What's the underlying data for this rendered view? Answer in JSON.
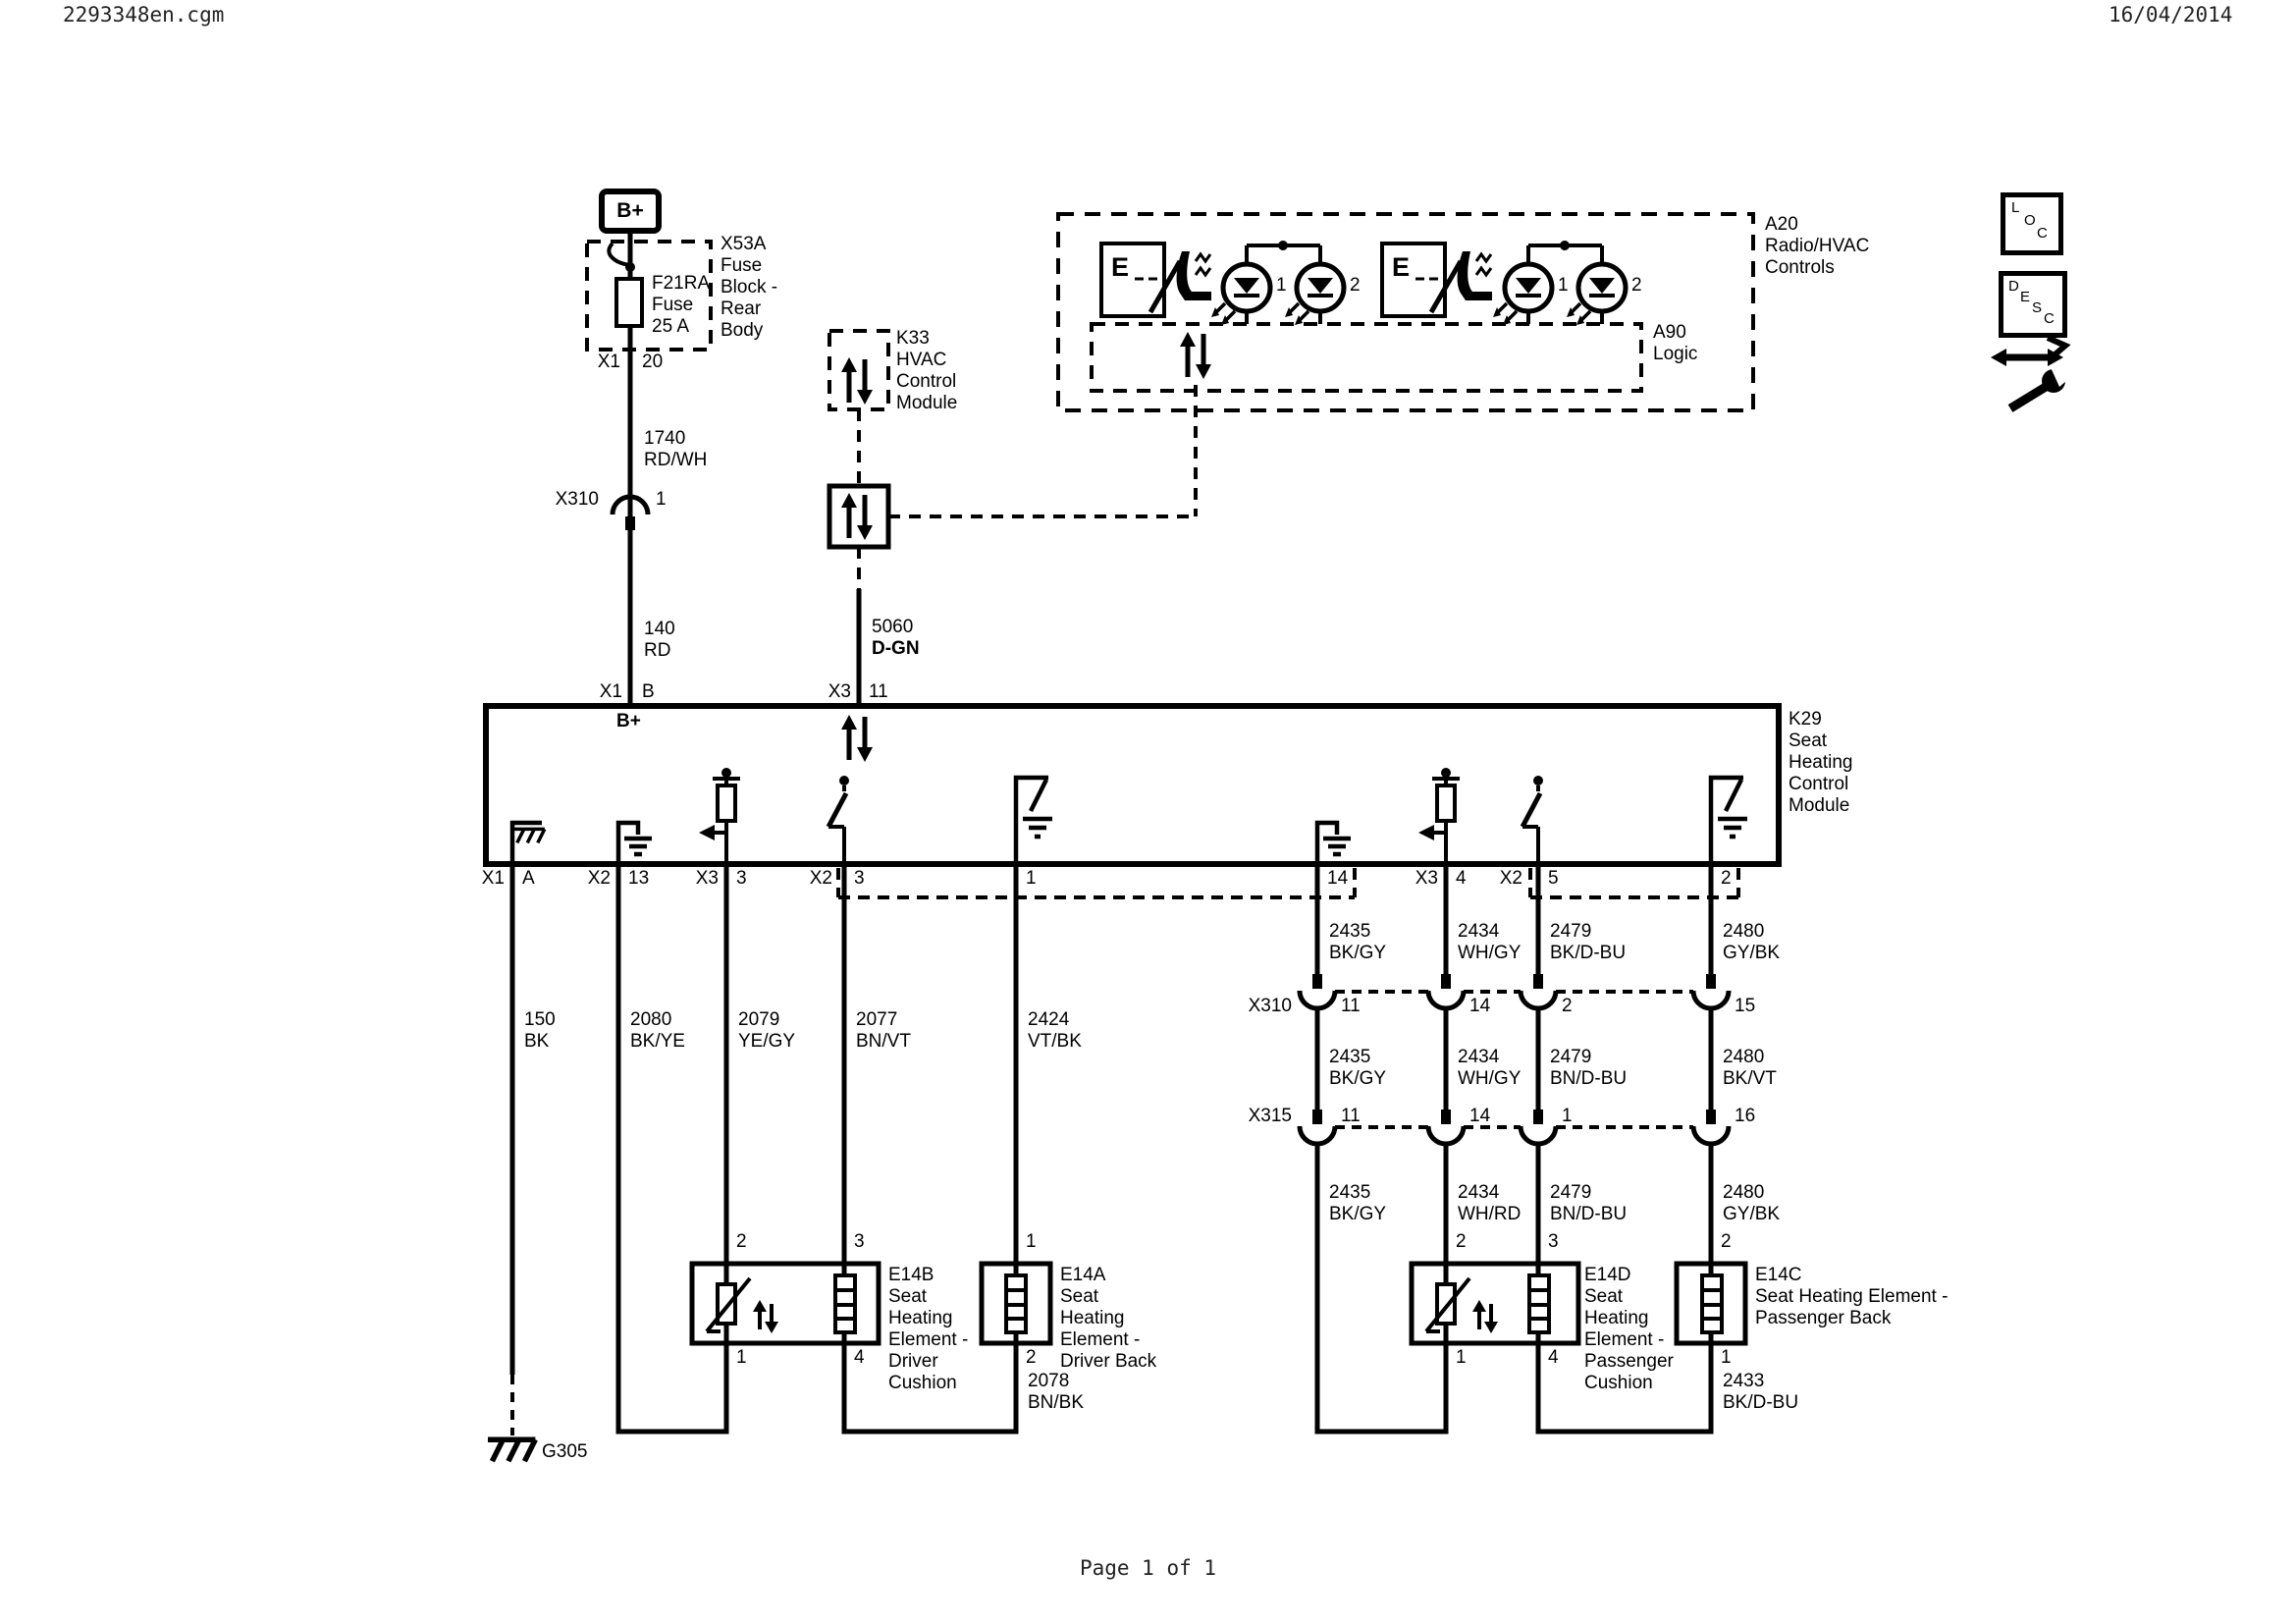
{
  "header": {
    "filename": "2293348en.cgm",
    "date": "16/04/2014"
  },
  "footer": {
    "page": "Page 1 of 1"
  },
  "legend": {
    "loc": [
      "L",
      "O",
      "C"
    ],
    "desc": [
      "D",
      "E",
      "S",
      "C"
    ]
  },
  "power": {
    "battery": "B+",
    "fuse_box_label": [
      "X53A",
      "Fuse",
      "Block -",
      "Rear",
      "Body"
    ],
    "fuse_label": [
      "F21RA",
      "Fuse",
      "25 A"
    ],
    "fuse_pin": {
      "conn": "X1",
      "pin": "20"
    },
    "wire_1740": {
      "num": "1740",
      "color": "RD/WH"
    },
    "conn_x310": {
      "name": "X310",
      "pin": "1"
    },
    "wire_140": {
      "num": "140",
      "color": "RD"
    },
    "k29_pin": {
      "conn": "X1",
      "pin": "B"
    },
    "internal": "B+"
  },
  "datalink": {
    "k33_label": [
      "K33",
      "HVAC",
      "Control",
      "Module"
    ],
    "wire_5060": {
      "num": "5060",
      "color": "D-GN"
    },
    "k29_pin": {
      "conn": "X3",
      "pin": "11"
    }
  },
  "hvac_controls": {
    "label": [
      "A20",
      "Radio/HVAC",
      "Controls"
    ],
    "logic_label": [
      "A90",
      "Logic"
    ],
    "switch1_letter": "E",
    "switch2_letter": "E",
    "leds": [
      "1",
      "2",
      "1",
      "2"
    ]
  },
  "k29": {
    "label": [
      "K29",
      "Seat",
      "Heating",
      "Control",
      "Module"
    ],
    "pins_bottom": [
      {
        "conn": "X1",
        "pin": "A"
      },
      {
        "conn": "X2",
        "pin": "13"
      },
      {
        "conn": "X3",
        "pin": "3"
      },
      {
        "conn": "X2",
        "pin": "3"
      },
      {
        "conn": "",
        "pin": "1"
      },
      {
        "conn": "",
        "pin": "14"
      },
      {
        "conn": "X3",
        "pin": "4"
      },
      {
        "conn": "X2",
        "pin": "5"
      },
      {
        "conn": "",
        "pin": "2"
      }
    ]
  },
  "wires_left": [
    {
      "num": "150",
      "color": "BK"
    },
    {
      "num": "2080",
      "color": "BK/YE"
    },
    {
      "num": "2079",
      "color": "YE/GY"
    },
    {
      "num": "2077",
      "color": "BN/VT"
    },
    {
      "num": "2424",
      "color": "VT/BK"
    }
  ],
  "wires_right_top": [
    {
      "num": "2435",
      "color": "BK/GY"
    },
    {
      "num": "2434",
      "color": "WH/GY"
    },
    {
      "num": "2479",
      "color": "BK/D-BU"
    },
    {
      "num": "2480",
      "color": "GY/BK"
    }
  ],
  "wires_right_mid": [
    {
      "num": "2435",
      "color": "BK/GY"
    },
    {
      "num": "2434",
      "color": "WH/GY"
    },
    {
      "num": "2479",
      "color": "BN/D-BU"
    },
    {
      "num": "2480",
      "color": "BK/VT"
    }
  ],
  "wires_right_bottom": [
    {
      "num": "2435",
      "color": "BK/GY"
    },
    {
      "num": "2434",
      "color": "WH/RD"
    },
    {
      "num": "2479",
      "color": "BN/D-BU"
    },
    {
      "num": "2480",
      "color": "GY/BK"
    }
  ],
  "connectors": {
    "x310": {
      "name": "X310",
      "pins": [
        "11",
        "14",
        "2",
        "15"
      ]
    },
    "x315": {
      "name": "X315",
      "pins": [
        "11",
        "14",
        "1",
        "16"
      ]
    }
  },
  "elements": {
    "e14b": {
      "label": [
        "E14B",
        "Seat",
        "Heating",
        "Element -",
        "Driver",
        "Cushion"
      ],
      "pins": {
        "tl": "2",
        "tr": "3",
        "bl": "1",
        "br": "4"
      }
    },
    "e14a": {
      "label": [
        "E14A",
        "Seat",
        "Heating",
        "Element -",
        "Driver Back"
      ],
      "pins": {
        "top": "1",
        "bottom": "2"
      }
    },
    "e14d": {
      "label": [
        "E14D",
        "Seat",
        "Heating",
        "Element -",
        "Passenger",
        "Cushion"
      ],
      "pins": {
        "tl": "2",
        "tr": "3",
        "bl": "1",
        "br": "4"
      }
    },
    "e14c": {
      "label": [
        "E14C",
        "Seat Heating Element -",
        "Passenger Back"
      ],
      "pins": {
        "top": "2",
        "bottom": "1"
      }
    }
  },
  "links": {
    "wire_2078": {
      "num": "2078",
      "color": "BN/BK"
    },
    "wire_2433": {
      "num": "2433",
      "color": "BK/D-BU"
    }
  },
  "grounds": {
    "g305": "G305"
  }
}
